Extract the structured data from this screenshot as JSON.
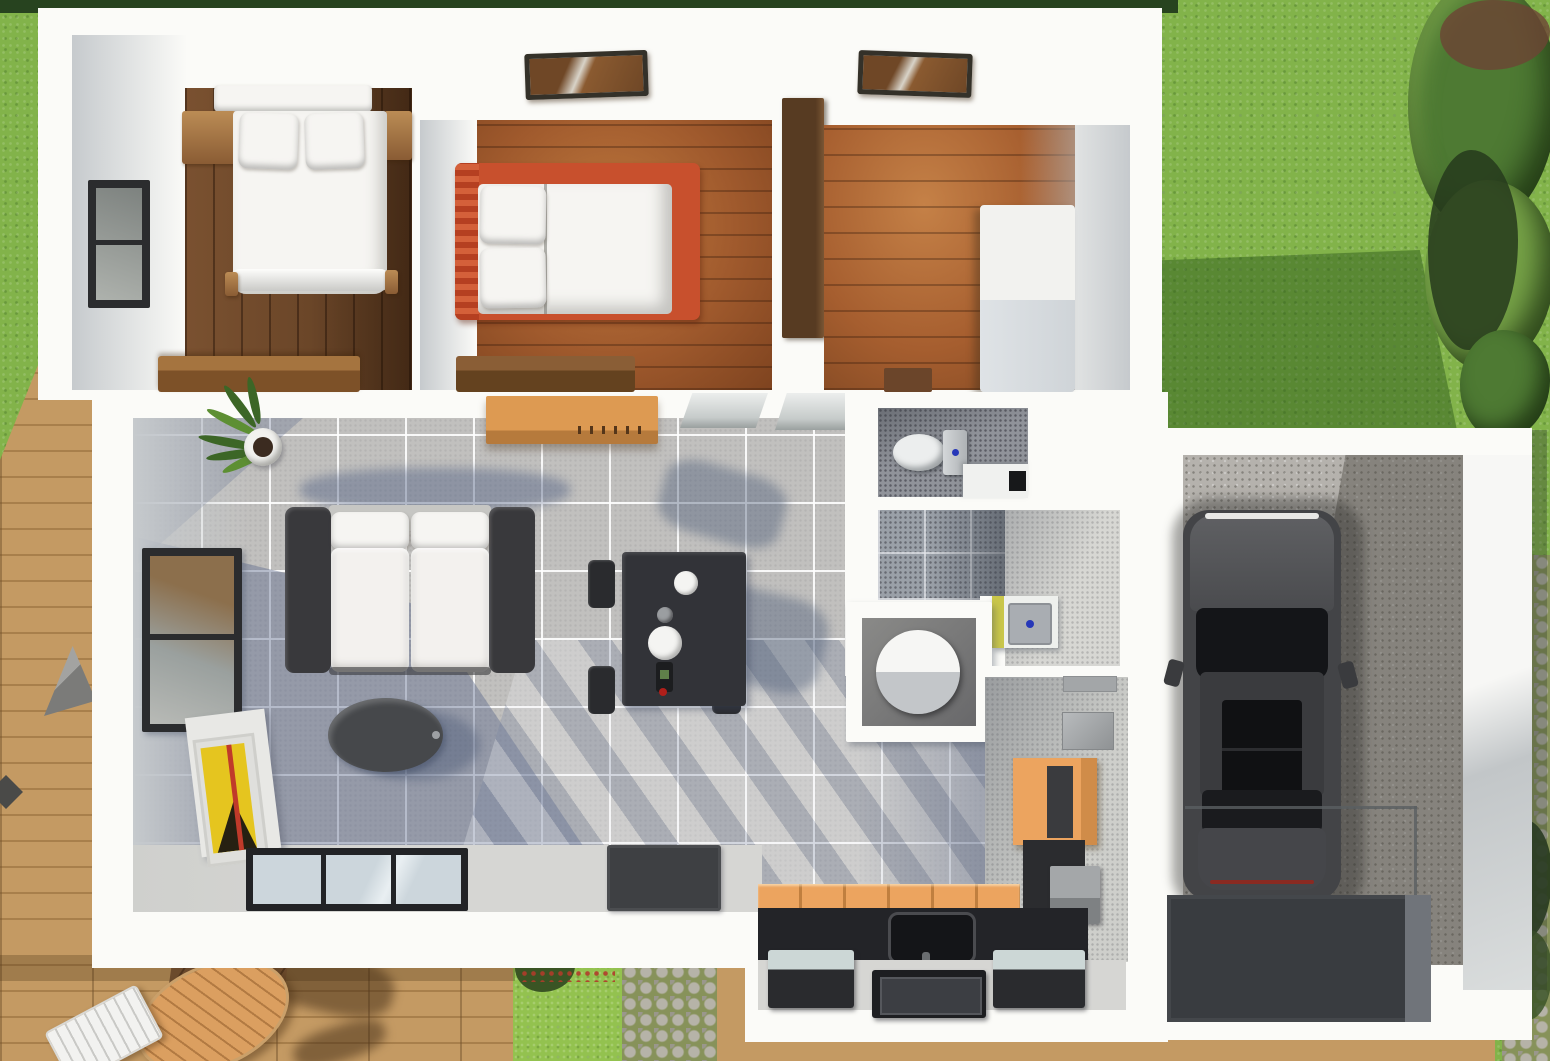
{
  "meta": {
    "view": "top-down 3d floor plan render",
    "visible_text": "none"
  },
  "palette": {
    "white": "#fbfbf8",
    "wallShade": "#c6cacd",
    "hedge": "#27431f",
    "grass": "#82b34a",
    "grassBright": "#93c24f",
    "grassDark": "#4f7e2e",
    "flowerRed": "#b03b2a",
    "deck": "#c49a63",
    "deckLine": "#a87f4b",
    "cobble": "#b6b3a8",
    "cobbleDark": "#9a978c",
    "moss": "#87925a",
    "vegDark": "#263a1c",
    "bushGreen": "#4e7a33",
    "bushLight": "#76a247",
    "tile": "#c1c0be",
    "hallFloor": "#d6d6d3",
    "shadowBlue": "#5a668a",
    "linen": "#f6f5f2",
    "cushion": "#f3f1ee",
    "sofaDark": "#39393c",
    "sofaBack": "#c6c6c3",
    "tableDark": "#323338",
    "chairDark": "#2a2b2e",
    "ovalTable": "#46484b",
    "rug": "#3e4043",
    "frameDark": "#343129",
    "windowFrame": "#2b2c2e",
    "glass": "#ccd6dc",
    "bedRed": "#c8502d",
    "woodFurn": "#bb8c55",
    "woodFurnDark": "#8a5c34",
    "wardrobe": "#573b22",
    "cabinetWhite": "#f2f2ef",
    "cabinetOrange": "#eca45f",
    "cabinetOrangeDark": "#c07f3f",
    "counter": "#232428",
    "applianceDark": "#2a2b2e",
    "applianceTop": "#ccd7d6",
    "stoveInner": "#3c3e43",
    "bathFloor": "#90939a",
    "bathTileMid": "#9aa0a8",
    "bathLight": "#d7d7d3",
    "sinkYellow": "#c9c64a",
    "ceramic": "#eceeee",
    "blueDot": "#2637b8",
    "concrete": "#b5b2ad",
    "carBody": "#434447",
    "carHood": "#5f6063",
    "carGlass": "#141518",
    "driveway": "#393c40",
    "curb": "#70747a",
    "artYellow": "#e5c51f",
    "artDark": "#262012",
    "artRed": "#c03a2a",
    "plantGreen": "#3c6626",
    "plantGreenLight": "#5d8f33",
    "potWhite": "#f2f2ef"
  },
  "objects": {
    "rooms": [
      "bedroom-1",
      "bedroom-2",
      "bedroom-3",
      "living-room",
      "dining-area",
      "wc",
      "bathroom",
      "kitchen",
      "garage"
    ],
    "furniture": [
      "double-bed",
      "single-bed-red",
      "nightstands",
      "dressers",
      "wardrobe",
      "white-cabinet",
      "sofa",
      "coffee-table",
      "dining-table",
      "chairs",
      "tv-shelf",
      "potted-plant",
      "artwork",
      "rug",
      "toilet",
      "shower-cylinder",
      "sink",
      "kitchen-counter",
      "stove",
      "appliances",
      "car",
      "outdoor-table",
      "outdoor-chairs"
    ],
    "outdoor": [
      "hedge",
      "lawn",
      "bushes",
      "wood-deck",
      "cobblestone-path",
      "flower-patch",
      "driveway-pad"
    ]
  }
}
